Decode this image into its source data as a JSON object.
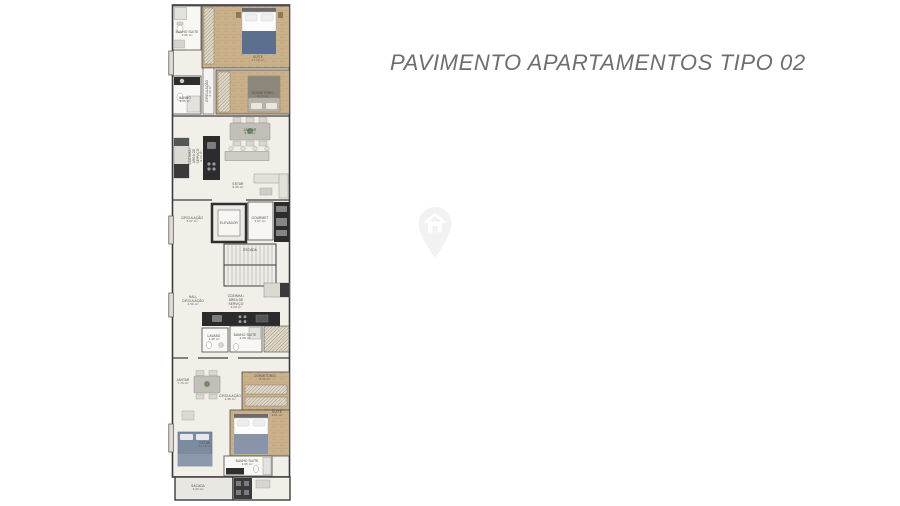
{
  "title": "PAVIMENTO APARTAMENTOS TIPO 02",
  "watermark_icon": "location-pin-house-icon",
  "colors": {
    "title_text": "#6e6e6e",
    "wall": "#3c3c3c",
    "wood_floor": "#cbb18b",
    "light_floor": "#f2efe9",
    "counter_dark": "#2b2b2b",
    "bed_blanket_blue": "#5c6f8e",
    "sofa_blue": "#7d8ba1",
    "watermark": "#f2f2f2"
  },
  "floorplan": {
    "rooms": [
      {
        "label": "BANHO SUITE",
        "area": "3.66 m²"
      },
      {
        "label": "SUITE",
        "area": "17.70 m²"
      },
      {
        "label": "CIRCULAÇÃO",
        "area": "2.16 m²"
      },
      {
        "label": "BANHO",
        "area": "3.05 m²"
      },
      {
        "label": "DORMITÓRIO",
        "area": "8.21 m²"
      },
      {
        "label": "COZINHA / ÁREA DE SERVIÇO",
        "area": "9.23 m²"
      },
      {
        "label": "JANTAR",
        "area": "8.40 m²"
      },
      {
        "label": "ESTAR",
        "area": "9.36 m²"
      },
      {
        "label": "CIRCULAÇÃO",
        "area": "5.67 m²"
      },
      {
        "label": "ELEVADOR",
        "area": ""
      },
      {
        "label": "GOURMET",
        "area": "3.07 m²"
      },
      {
        "label": "ESCADA",
        "area": ""
      },
      {
        "label": "HALL CIRCULAÇÃO",
        "area": "4.59 m²"
      },
      {
        "label": "COZINHA / ÁREA DE SERVIÇO",
        "area": "9.00 m²"
      },
      {
        "label": "LAVABO",
        "area": "1.48 m²"
      },
      {
        "label": "BANHO SUITE",
        "area": "2.28 m²"
      },
      {
        "label": "JANTAR",
        "area": "7.70 m²"
      },
      {
        "label": "CIRCULAÇÃO",
        "area": "1.35 m²"
      },
      {
        "label": "DORMITÓRIO",
        "area": "8.01 m²"
      },
      {
        "label": "SUITE",
        "area": "9.01 m²"
      },
      {
        "label": "ESTAR",
        "area": "14.18 m²"
      },
      {
        "label": "BANHO SUITE",
        "area": "3.05 m²"
      },
      {
        "label": "SACADA",
        "area": "3.20 m²"
      }
    ]
  }
}
